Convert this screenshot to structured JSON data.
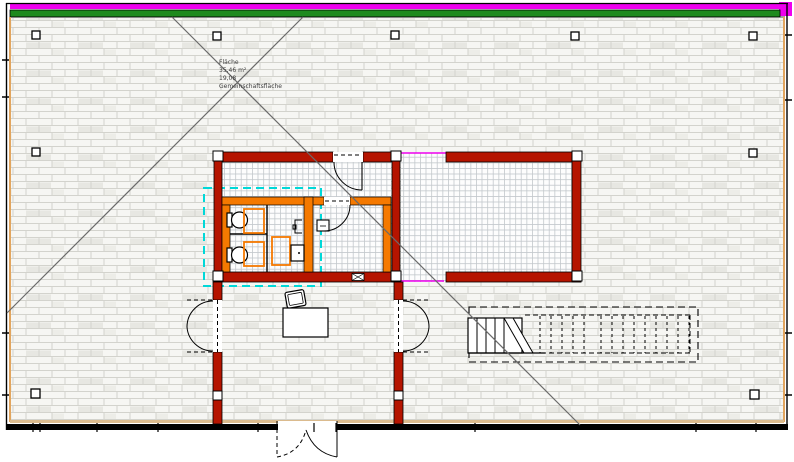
{
  "annotation": {
    "lines": [
      "Fläche",
      "35,46 m²",
      "19,08",
      "Gemeinschaftsfläche"
    ]
  },
  "colors": {
    "band_magenta": "#ee00ee",
    "band_green": "#1e8a1e",
    "wall_red": "#b51400",
    "wall_orange": "#f57900",
    "highlight_cyan": "#00d8d8",
    "trim_tan": "#dbbb8e",
    "trim_orange": "#e2a55e",
    "diagonal_gray": "#6a6a6a",
    "hatch_line": "#d3d3cd",
    "grid_line": "#c3c8cc"
  }
}
